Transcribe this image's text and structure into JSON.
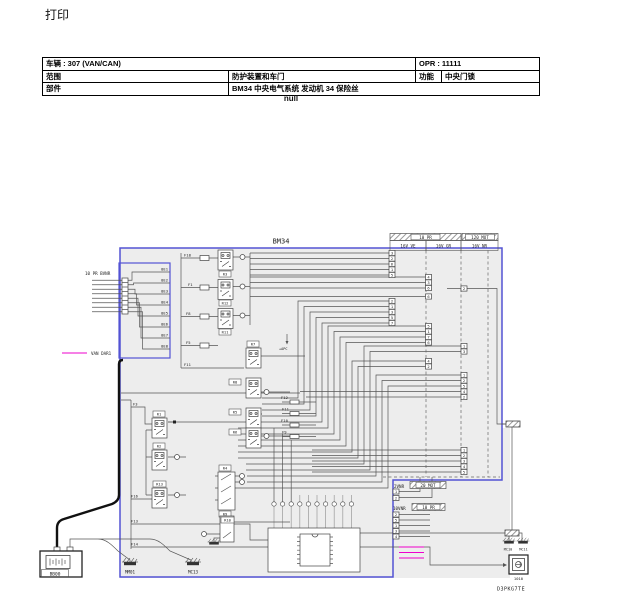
{
  "colors": {
    "accent_blue": "#5353d4",
    "magenta": "#ee00cc",
    "panel_gray": "#ededed",
    "wire": "#555555"
  },
  "page": {
    "title": "打印",
    "null_label": "null",
    "sheet_code": "D3PKG7TE"
  },
  "info_table": {
    "vehicle": "车辆 : 307 (VAN/CAN)",
    "opr": "OPR : 11111",
    "scope_label": "范围",
    "scope_value": "防护装置和车门",
    "function_label": "功能",
    "function_value": "中央门锁",
    "part_label": "部件",
    "part_value": "BM34 中央电气系统 发动机 34 保险丝"
  },
  "diagram": {
    "title": "BM34",
    "left_connector_label": "10 PR BVNR",
    "bus_legend": "VAN DAR1",
    "wire_labels": [
      "8E1",
      "8E2",
      "8E3",
      "8E4",
      "8E5",
      "8E6",
      "8E7",
      "8E8"
    ],
    "headers": {
      "band1": "10 PR",
      "band2": "120 MOT",
      "col1": "16V VE",
      "col2": "16V GR",
      "col3": "16V NR"
    },
    "bottom_connectors": {
      "a_label": "2VNR",
      "a_conn": "20 MOT",
      "b_label": "10VNR",
      "b_conn": "10 PR"
    },
    "relays": {
      "r1": "R1",
      "r2": "R2",
      "r3": "R3",
      "r4": "R4",
      "r5": "R5",
      "r6": "R6",
      "r7": "R7",
      "r8": "R8",
      "r9": "R9",
      "r10": "R10",
      "r11": "R11",
      "r12": "R12",
      "r13": "R13"
    },
    "fuses": {
      "f1": "F1",
      "f3": "F3",
      "f5": "F5",
      "f8": "F8",
      "f9": "F9",
      "f10": "F10",
      "f11": "F11",
      "f11b": "F11",
      "f12": "F12",
      "f13": "F13",
      "f14": "F14",
      "f16": "F16",
      "f18": "F18"
    },
    "annotations": {
      "apc": "+APC"
    },
    "components": {
      "battery": "BB00",
      "ground1": "MM01",
      "ground2": "MC13",
      "ground3": "MC10",
      "ground4": "MC11",
      "unit": "1010"
    },
    "pins_ve": [
      "3",
      "2",
      "6",
      "1",
      "5",
      "2",
      "1",
      "3",
      "5",
      "7"
    ],
    "pins_gr": [
      "4",
      "3",
      "6",
      "6",
      "5",
      "1",
      "7",
      "6",
      "4",
      "2"
    ],
    "pins_nr": [
      "2",
      "1",
      "3",
      "1",
      "2",
      "5",
      "4",
      "2",
      "1",
      "2",
      "3",
      "4",
      "5"
    ],
    "pins_2vnr": [
      "1",
      "2"
    ],
    "pins_10vnr": [
      "2",
      "5",
      "1",
      "3",
      "4"
    ]
  }
}
